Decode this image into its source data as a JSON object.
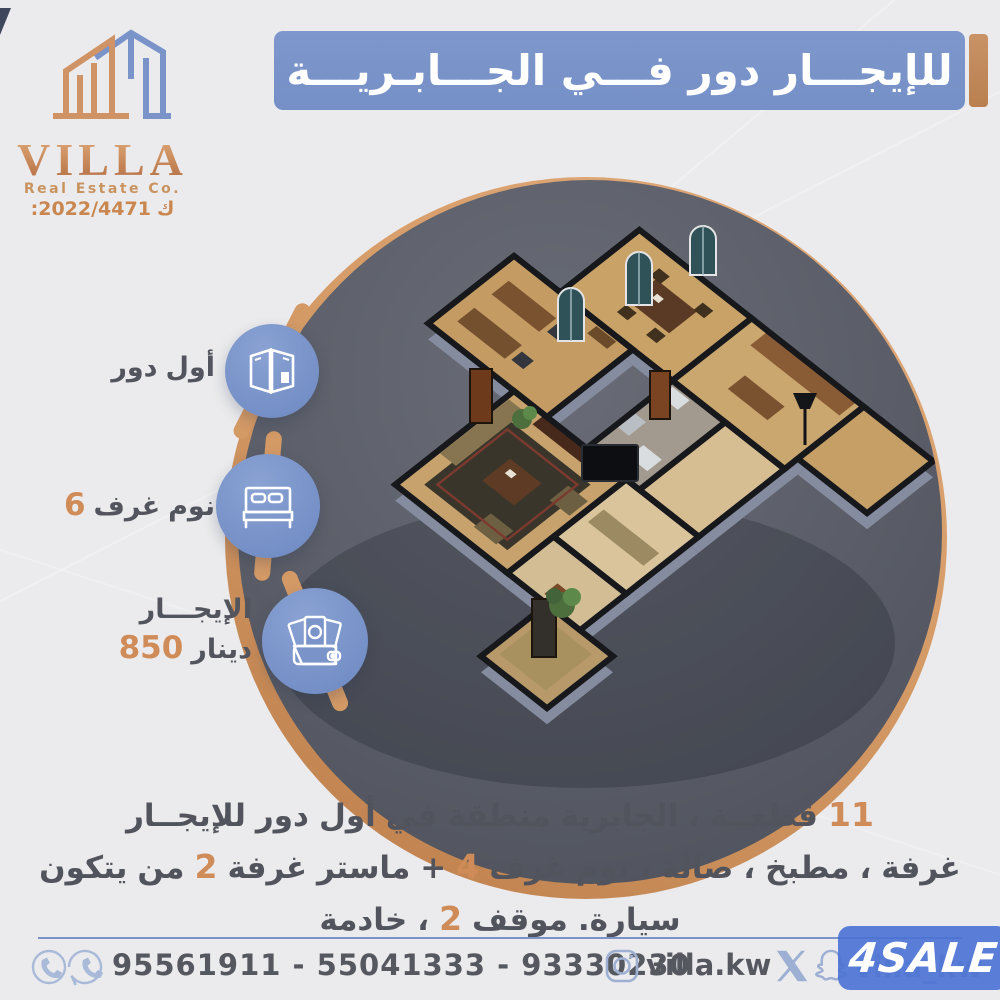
{
  "colors": {
    "accent_blue": "#7a93c9",
    "copper": "#d08c58",
    "copper_deep": "#bd7f4c",
    "text_dark": "#51545c",
    "circle_dark": "#5a5d67",
    "badge_blue": "#4a72d4"
  },
  "logo": {
    "name": "VILLA",
    "subtitle": "Real Estate Co.",
    "license_tokens": [
      "2022/4471:",
      "ك"
    ]
  },
  "banner": {
    "title": "للإيجـــار دور فـــي الجـــابـريـــة"
  },
  "features": [
    {
      "icon": "floorplan-icon",
      "lines": [
        [
          "دور",
          "أول"
        ]
      ]
    },
    {
      "icon": "bed-icon",
      "lines": [
        [
          "6",
          "غرف",
          "نوم"
        ]
      ]
    },
    {
      "icon": "money-icon",
      "lines": [
        [
          "الإيجـــار"
        ],
        [
          "850",
          "دينار"
        ]
      ]
    }
  ],
  "description": {
    "lines": [
      [
        "للإيجــار",
        "دور",
        "أول",
        "في",
        "منطقة",
        "الجابرية",
        "،",
        "قطعــة",
        "11"
      ],
      [
        "يتكون",
        "من",
        "2",
        "غرفة",
        "ماستر",
        "+",
        "4",
        "غرف",
        "نوم",
        "،",
        "صالة",
        "،",
        "مطبخ",
        "،",
        "غرفة"
      ],
      [
        "خادمة",
        "،",
        "2",
        "موقف",
        "سيارة."
      ]
    ]
  },
  "footer": {
    "phones": "95561911 - 55041333 - 93330230",
    "instagram": "villa.kw",
    "snapchat_handle": "villa_kw",
    "badge": "4SALE"
  }
}
